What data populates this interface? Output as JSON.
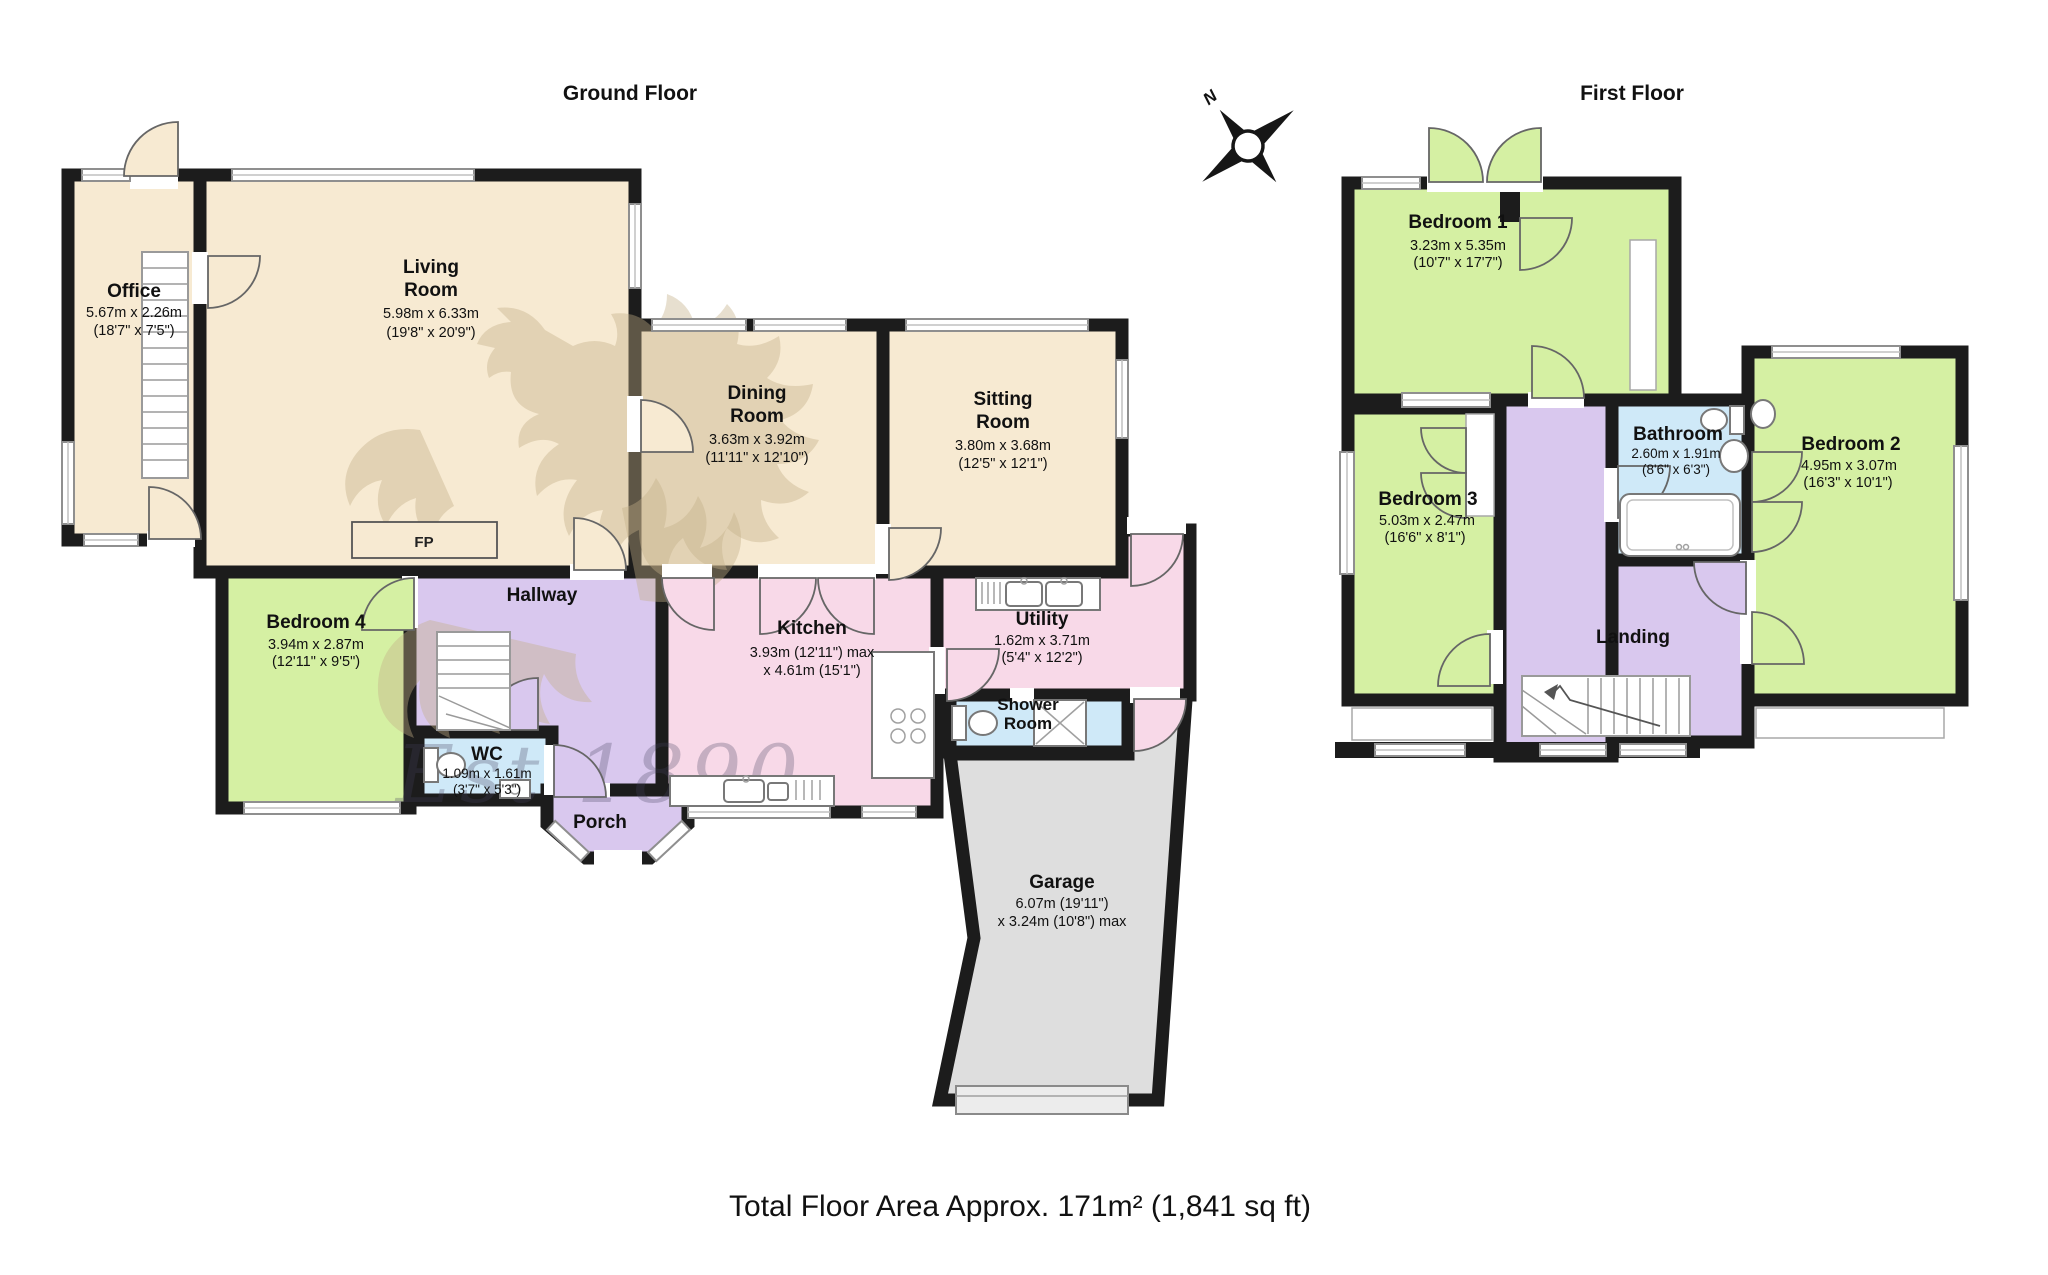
{
  "titles": {
    "ground_floor": "Ground Floor",
    "first_floor": "First Floor"
  },
  "footer": {
    "total_area": "Total Floor Area Approx. 171m² (1,841 sq ft)"
  },
  "compass": {
    "north_label": "N"
  },
  "watermark": {
    "text": "Est 1890"
  },
  "colors": {
    "walls": "#1c1c1c",
    "room_tan": "#f7ead2",
    "room_green": "#d5f0a3",
    "room_purple": "#d9c8ee",
    "room_pink": "#f8d9e8",
    "room_blue": "#cfe9f8",
    "garage_gray": "#dedede",
    "watermark_tan": "#c4ae88"
  },
  "floors": {
    "ground": {
      "title": "Ground Floor",
      "rooms": {
        "office": {
          "line1": "Office",
          "line2": "5.67m x 2.26m",
          "line3": "(18'7\" x 7'5\")"
        },
        "living": {
          "line1": "Living",
          "line2": "Room",
          "line3": "5.98m x 6.33m",
          "line4": "(19'8\" x 20'9\")"
        },
        "dining": {
          "line1": "Dining",
          "line2": "Room",
          "line3": "3.63m x 3.92m",
          "line4": "(11'11\" x 12'10\")"
        },
        "sitting": {
          "line1": "Sitting",
          "line2": "Room",
          "line3": "3.80m x 3.68m",
          "line4": "(12'5\" x 12'1\")"
        },
        "bedroom4": {
          "line1": "Bedroom 4",
          "line2": "3.94m x 2.87m",
          "line3": "(12'11\" x 9'5\")"
        },
        "hallway": {
          "line1": "Hallway"
        },
        "wc": {
          "line1": "WC",
          "line2": "1.09m x 1.61m",
          "line3": "(3'7\" x 5'3\")"
        },
        "porch": {
          "line1": "Porch"
        },
        "kitchen": {
          "line1": "Kitchen",
          "line2": "3.93m (12'11\") max",
          "line3": "x 4.61m (15'1\")"
        },
        "utility": {
          "line1": "Utility",
          "line2": "1.62m x 3.71m",
          "line3": "(5'4\" x 12'2\")"
        },
        "shower": {
          "line1": "Shower",
          "line2": "Room"
        },
        "garage": {
          "line1": "Garage",
          "line2": "6.07m (19'11\")",
          "line3": "x 3.24m (10'8\") max"
        },
        "fireplace": {
          "label": "FP"
        }
      }
    },
    "first": {
      "title": "First Floor",
      "rooms": {
        "bedroom1": {
          "line1": "Bedroom 1",
          "line2": "3.23m x 5.35m",
          "line3": "(10'7\" x 17'7\")"
        },
        "bedroom2": {
          "line1": "Bedroom 2",
          "line2": "4.95m x 3.07m",
          "line3": "(16'3\" x 10'1\")"
        },
        "bedroom3": {
          "line1": "Bedroom 3",
          "line2": "5.03m x 2.47m",
          "line3": "(16'6\" x 8'1\")"
        },
        "bathroom": {
          "line1": "Bathroom",
          "line2": "2.60m x 1.91m",
          "line3": "(8'6\" x 6'3\")"
        },
        "landing": {
          "line1": "Landing"
        }
      }
    }
  }
}
